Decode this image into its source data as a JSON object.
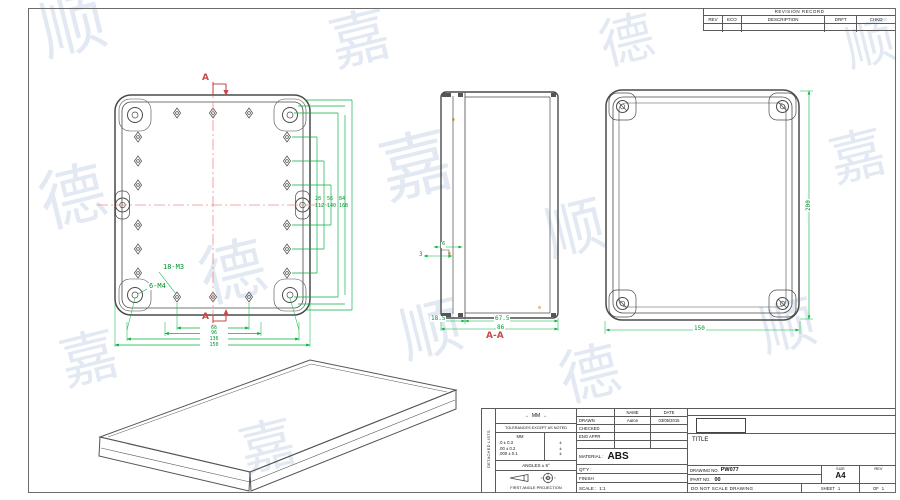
{
  "watermark": {
    "chars": [
      "顺",
      "嘉",
      "德"
    ]
  },
  "revision": {
    "title": "REVISION RECORD",
    "cols": [
      "REV",
      "ECO",
      "DESCRIPTION",
      "DRFT",
      "CHKD"
    ]
  },
  "front": {
    "section_marker": "A",
    "bosses_label": "18-M3",
    "screws_label": "6-M4",
    "side_dims": [
      "28",
      "56",
      "84",
      "112",
      "140",
      "168"
    ],
    "bottom_dims": [
      "66",
      "96",
      "136",
      "150"
    ]
  },
  "section": {
    "label": "A-A",
    "dim_step_top": "6",
    "dim_step": "3",
    "dim_lid": "18.5",
    "dim_base": "67.5",
    "dim_overall": "86"
  },
  "side_view": {
    "dim_height": "200",
    "dim_width": "150"
  },
  "title_block": {
    "arrow_left": "←",
    "arrow_right": "→",
    "units_note": "MM",
    "tolerance_note": "TOLERANCES EXCEPT AS NOTED",
    "tol_header": "MM",
    "tol_rows": [
      ".0 ± 0.3",
      ".00 ± 0.2",
      ".000 ± 0.1"
    ],
    "tol_marks": [
      "±",
      "±",
      "±"
    ],
    "angles_note": "ANGLES ± 5°",
    "projection_note": "FIRST ANGLE PROJECTION",
    "side_strip": "DETACHED LISTS",
    "name_header": "NAME",
    "date_header": "DATE",
    "drawn_label": "DRAWN",
    "drawn_name": "Aaron",
    "drawn_date": "03/05/2015",
    "checked_label": "CHECKED",
    "eng_label": "ENG APPR",
    "material_label": "MATERIAL :",
    "material_value": "ABS",
    "qty_label": "QT'Y :",
    "finish_label": "FINISH",
    "scale_label": "SCALE :",
    "scale_value": "1:1",
    "title_label": "TITLE",
    "drawing_no_label": "DRAWING NO.",
    "drawing_no_value": "PW077",
    "part_no_label": "/PART NO.",
    "part_no_value": "00",
    "size_label": "SIZE",
    "size_value": "A4",
    "rev_label": "REV",
    "no_scale_note": "DO NOT SCALE DRAWING",
    "sheet_label": "SHEET",
    "sheet_value": "1",
    "of_label": "OF",
    "of_value": "1"
  }
}
